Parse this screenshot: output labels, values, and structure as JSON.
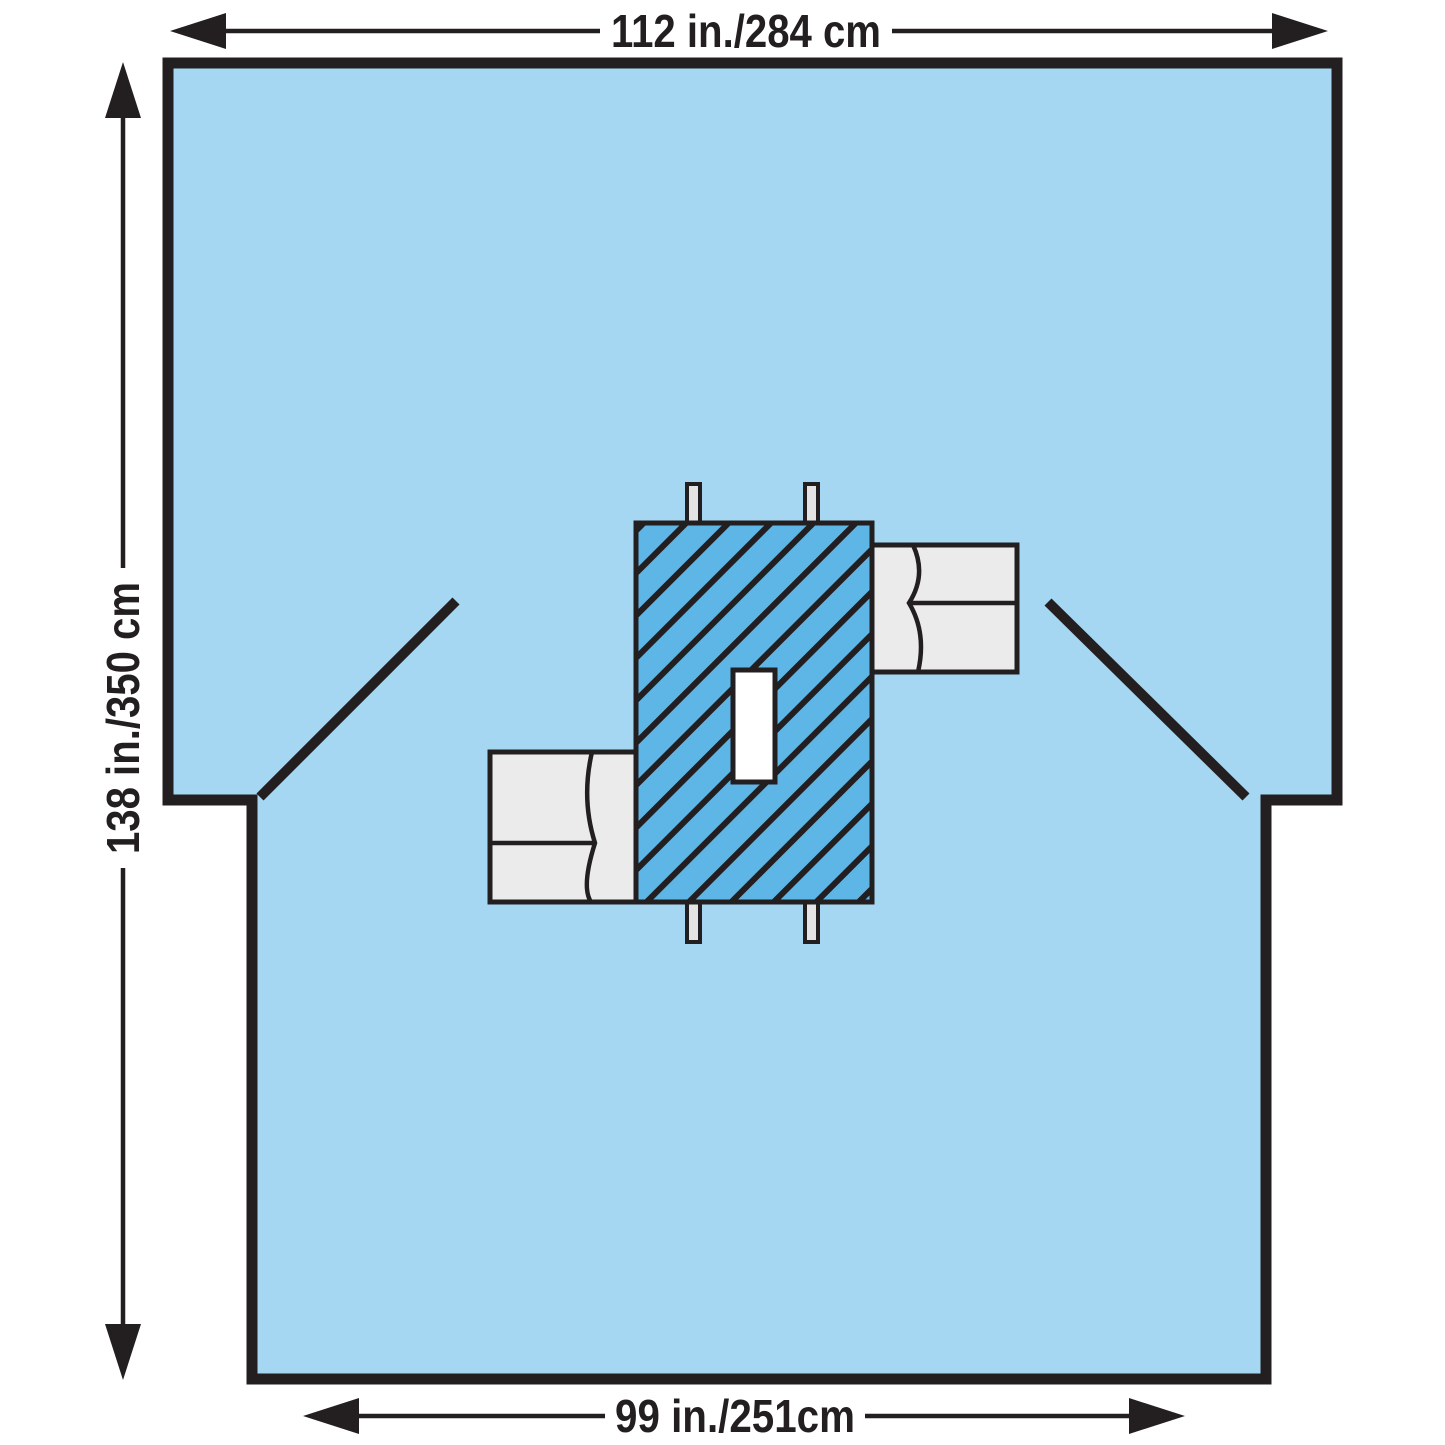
{
  "diagram": {
    "dimension_labels": {
      "top": "112 in./284 cm",
      "left": "138 in./350 cm",
      "bottom": "99 in./251cm"
    },
    "colors": {
      "drape_blue": "#A6D7F2",
      "reinforcement_blue": "#5EB6E6",
      "armboard_gray": "#EBEBEB",
      "tab_gray": "#E4E4E4",
      "fenestration_white": "#FFFFFF",
      "outline_black": "#231F20",
      "background_white": "#FFFFFF"
    }
  }
}
